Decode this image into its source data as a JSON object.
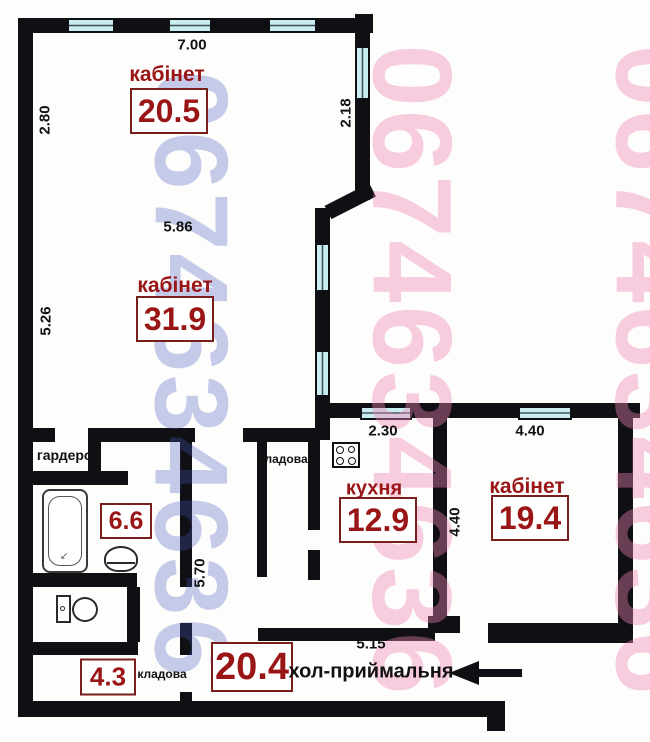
{
  "watermark": {
    "phone": "0674634636"
  },
  "rooms": {
    "cabinet_top": {
      "label": "кабінет",
      "area": "20.5"
    },
    "cabinet_mid": {
      "label": "кабінет",
      "area": "31.9"
    },
    "kitchen": {
      "label": "кухня",
      "area": "12.9"
    },
    "cabinet_right": {
      "label": "кабінет",
      "area": "19.4"
    },
    "bathroom": {
      "area": "6.6"
    },
    "wardrobe": {
      "label": "гардероб"
    },
    "storage_top": {
      "label": "кладова"
    },
    "storage_bottom": {
      "label": "кладова",
      "area": "4.3"
    },
    "hall": {
      "label": "хол-приймальня",
      "area": "20.4"
    }
  },
  "dimensions": {
    "top_width": "7.00",
    "left_upper_height": "2.80",
    "right_upper_height": "2.18",
    "mid_width": "5.86",
    "left_mid_height": "5.26",
    "kitchen_window_width": "2.30",
    "cabinet_right_width": "4.40",
    "kitchen_height": "4.40",
    "corridor_length": "5.70",
    "hall_width": "5.15"
  },
  "colors": {
    "wall": "#101014",
    "window_glass": "#c9eef2",
    "room_label": "#9a1616",
    "area_box_border": "#7a1d1d",
    "dimension_text": "#111111",
    "watermark_blue": "rgba(70,85,190,0.30)",
    "watermark_pink": "rgba(240,130,180,0.40)"
  }
}
